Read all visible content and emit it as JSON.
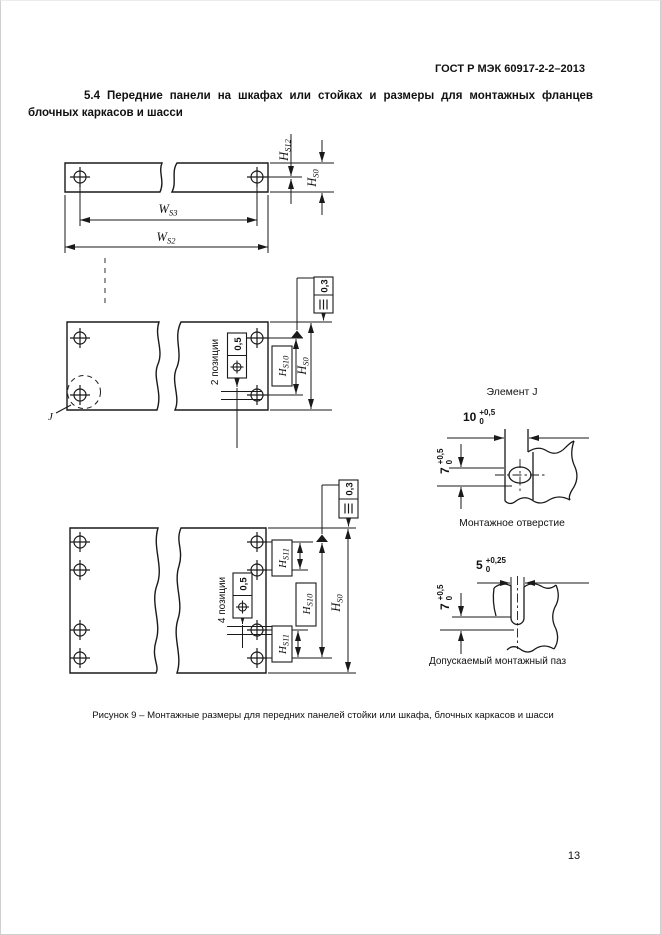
{
  "page": {
    "standard_header": "ГОСТ Р МЭК 60917-2-2–2013",
    "page_number": "13"
  },
  "section": {
    "heading_line1": "5.4 Передние панели на шкафах или стойках и размеры для монтажных фланцев",
    "heading_line2": "блочных каркасов и шасси"
  },
  "figure": {
    "caption": "Рисунок 9 – Монтажные размеры для передних панелей стойки или шкафа, блочных каркасов и шасси",
    "strip_view": {
      "dim_ws3": {
        "base": "W",
        "sub": "S3"
      },
      "dim_ws2": {
        "base": "W",
        "sub": "S2"
      },
      "dim_hs12": {
        "base": "H",
        "sub": "S12"
      },
      "dim_hs0": {
        "base": "H",
        "sub": "S0"
      }
    },
    "two_hole_view": {
      "positions_label": "2 позиции",
      "position_tolerance": "0,5",
      "symmetry_tolerance": "0,3",
      "dim_hs10": {
        "base": "H",
        "sub": "S10"
      },
      "dim_hs0": {
        "base": "H",
        "sub": "S0"
      },
      "detail_marker": "J"
    },
    "four_hole_view": {
      "positions_label": "4 позиции",
      "position_tolerance": "0,5",
      "symmetry_tolerance": "0,3",
      "dim_hs11_top": {
        "base": "H",
        "sub": "S11"
      },
      "dim_hs10": {
        "base": "H",
        "sub": "S10"
      },
      "dim_hs11_bottom": {
        "base": "H",
        "sub": "S11"
      },
      "dim_hs0": {
        "base": "H",
        "sub": "S0"
      }
    },
    "hole_detail": {
      "title": "Элемент J",
      "caption": "Монтажное отверстие",
      "width_value": "10",
      "width_tol_upper": "+0,5",
      "width_tol_lower": "0",
      "offset_value": "7",
      "offset_tol_upper": "+0,5",
      "offset_tol_lower": "0"
    },
    "slot_detail": {
      "caption": "Допускаемый монтажный паз",
      "width_value": "5",
      "width_tol_upper": "+0,25",
      "width_tol_lower": "0",
      "offset_value": "7",
      "offset_tol_upper": "+0,5",
      "offset_tol_lower": "0"
    },
    "icons": {
      "position_tolerance_icon": "⌖",
      "symmetry_tolerance_icon": "≡"
    }
  }
}
